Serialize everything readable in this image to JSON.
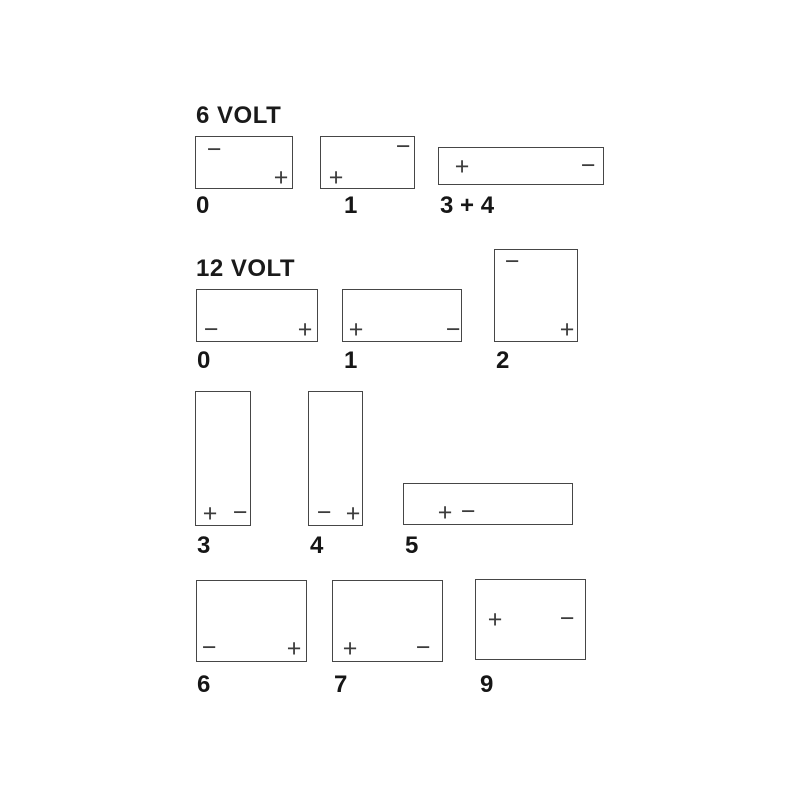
{
  "diagram": {
    "description": "Battery terminal position layout diagram",
    "colors": {
      "background": "#ffffff",
      "box_border": "#464646",
      "label_text": "#161616",
      "terminal_mark": "#3c3c3c"
    },
    "symbols": {
      "positive": "+",
      "negative": "−"
    }
  },
  "sections": [
    {
      "title": "6 VOLT",
      "batteries": [
        {
          "label": "0",
          "terminals": [
            {
              "polarity": "negative",
              "symbol": "−",
              "position": "top-left"
            },
            {
              "polarity": "positive",
              "symbol": "+",
              "position": "bottom-right"
            }
          ]
        },
        {
          "label": "1",
          "terminals": [
            {
              "polarity": "negative",
              "symbol": "−",
              "position": "top-right"
            },
            {
              "polarity": "positive",
              "symbol": "+",
              "position": "bottom-left"
            }
          ]
        },
        {
          "label": "3 + 4",
          "terminals": [
            {
              "polarity": "positive",
              "symbol": "+",
              "position": "left"
            },
            {
              "polarity": "negative",
              "symbol": "−",
              "position": "right"
            }
          ]
        }
      ]
    },
    {
      "title": "12 VOLT",
      "batteries": [
        {
          "label": "0",
          "terminals": [
            {
              "polarity": "negative",
              "symbol": "−",
              "position": "bottom-left"
            },
            {
              "polarity": "positive",
              "symbol": "+",
              "position": "bottom-right"
            }
          ]
        },
        {
          "label": "1",
          "terminals": [
            {
              "polarity": "positive",
              "symbol": "+",
              "position": "bottom-left"
            },
            {
              "polarity": "negative",
              "symbol": "−",
              "position": "bottom-right"
            }
          ]
        },
        {
          "label": "2",
          "terminals": [
            {
              "polarity": "negative",
              "symbol": "−",
              "position": "top-left"
            },
            {
              "polarity": "positive",
              "symbol": "+",
              "position": "bottom-right"
            }
          ]
        },
        {
          "label": "3",
          "terminals": [
            {
              "polarity": "positive",
              "symbol": "+",
              "position": "bottom-left"
            },
            {
              "polarity": "negative",
              "symbol": "−",
              "position": "bottom-right"
            }
          ]
        },
        {
          "label": "4",
          "terminals": [
            {
              "polarity": "negative",
              "symbol": "−",
              "position": "bottom-left"
            },
            {
              "polarity": "positive",
              "symbol": "+",
              "position": "bottom-right"
            }
          ]
        },
        {
          "label": "5",
          "terminals": [
            {
              "polarity": "positive",
              "symbol": "+",
              "position": "bottom-left-center"
            },
            {
              "polarity": "negative",
              "symbol": "−",
              "position": "bottom-center"
            }
          ]
        },
        {
          "label": "6",
          "terminals": [
            {
              "polarity": "negative",
              "symbol": "−",
              "position": "bottom-left"
            },
            {
              "polarity": "positive",
              "symbol": "+",
              "position": "bottom-right"
            }
          ]
        },
        {
          "label": "7",
          "terminals": [
            {
              "polarity": "positive",
              "symbol": "+",
              "position": "bottom-left"
            },
            {
              "polarity": "negative",
              "symbol": "−",
              "position": "bottom-right"
            }
          ]
        },
        {
          "label": "9",
          "terminals": [
            {
              "polarity": "positive",
              "symbol": "+",
              "position": "middle-left"
            },
            {
              "polarity": "negative",
              "symbol": "−",
              "position": "middle-right"
            }
          ]
        }
      ]
    }
  ]
}
